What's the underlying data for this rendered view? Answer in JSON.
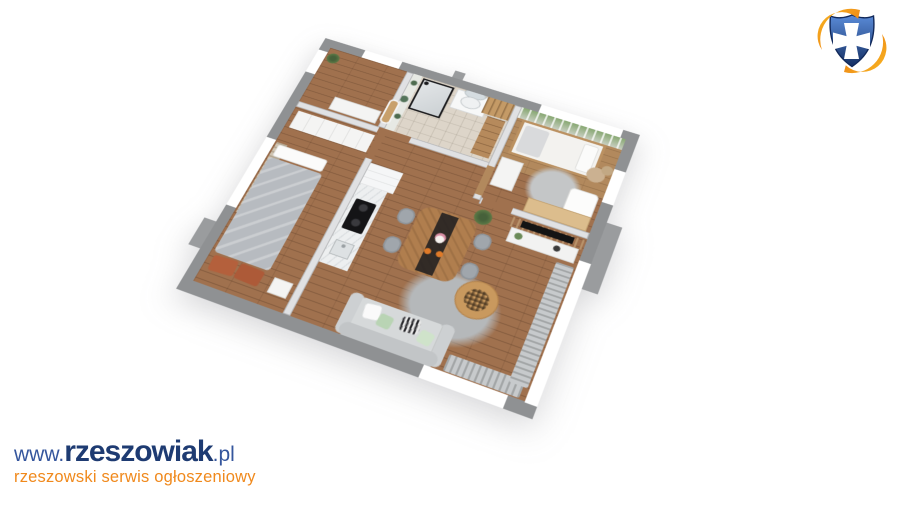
{
  "watermark": {
    "line1": {
      "prefix": "www.",
      "brand": "rzeszowiak",
      "suffix": ".pl"
    },
    "line2": "rzeszowski serwis ogłoszeniowy",
    "colors": {
      "url": "#35569d",
      "brand": "#1e3b72",
      "tagline": "#f0891c"
    }
  },
  "logo": {
    "name": "rzeszowiak-shield-crest",
    "shield_dark": "#142f63",
    "shield_light": "#5a8bd8",
    "cross": "#ffffff",
    "swoosh_dark": "#e8700f",
    "swoosh_light": "#f9b823"
  },
  "floorplan": {
    "type": "3d-apartment-render",
    "rooms": [
      "hall",
      "bathroom",
      "children-room",
      "bedroom",
      "kitchen",
      "dining-area",
      "living-area"
    ],
    "furniture": [
      "double-bed",
      "wardrobe",
      "nightstand",
      "kitchen-counter",
      "induction-hob",
      "kitchen-sink",
      "dining-table",
      "dining-chairs",
      "hanging-plant",
      "sofa",
      "coffee-table",
      "area-rug",
      "tv-slat-partition",
      "sideboard",
      "house-bed",
      "toy-shelf",
      "kids-table",
      "teddy-bear",
      "desk",
      "shower",
      "vanity-with-mirror",
      "wooden-cabinet",
      "staircase",
      "forest-mural",
      "curtains",
      "arched-door"
    ],
    "palette": {
      "outer_wall": "#8f9193",
      "inner_wall": "#e0e1e3",
      "wood_floor": "#a0714e",
      "kids_floor": "#b2895d",
      "bath_floor": "#ddd5c9",
      "rug": "#b5b8ba",
      "sofa": "#d6d9da",
      "duvet": "#b7bbc0",
      "pillow_accent": "#b4603c",
      "counter": "#edeff0",
      "hob": "#141416",
      "mural_green": "#88a873",
      "table_wood": "#b07e4e",
      "chair": "#a0a6ac",
      "curtain_beige": "#cfc4b1"
    }
  }
}
